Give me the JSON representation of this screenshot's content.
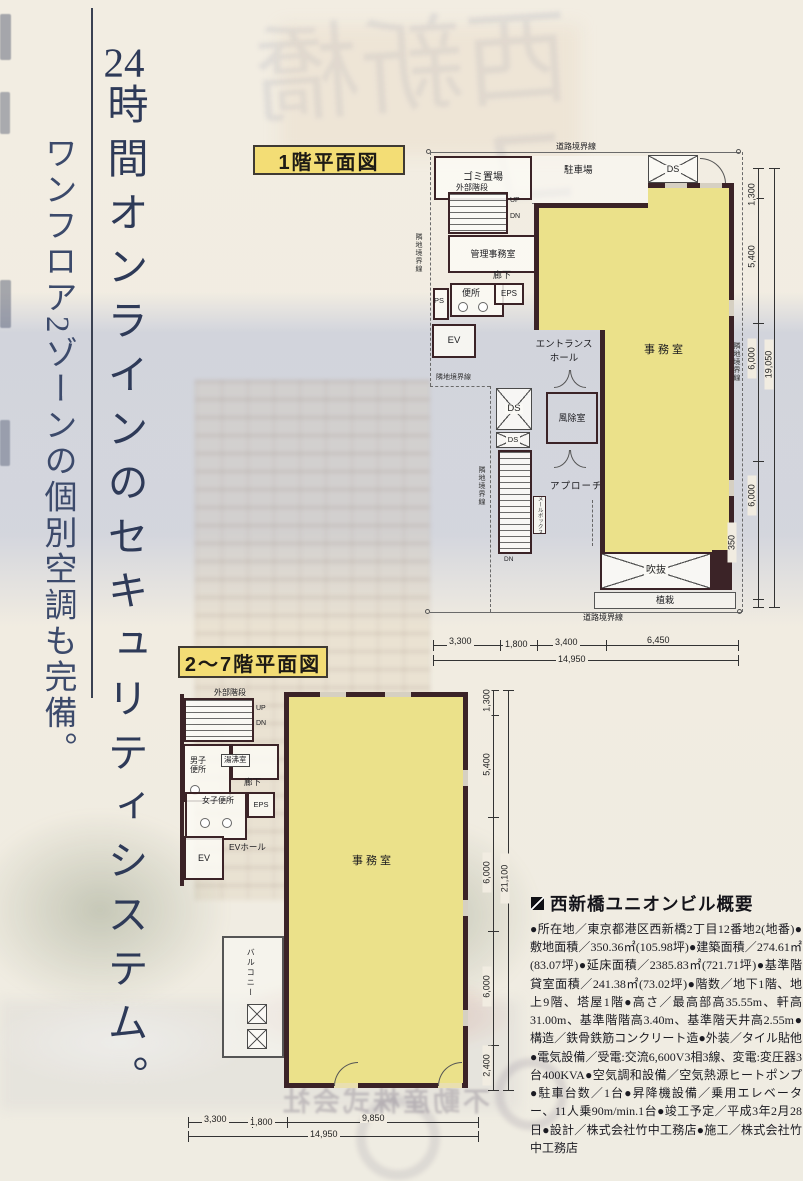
{
  "headline": {
    "num": "24",
    "line1_rest": "時間オンラインのセキュリティシステム。",
    "line2": "ワンフロア2ゾーンの個別空調も完備。"
  },
  "plan1": {
    "title": "1階平面図",
    "labels": {
      "road_boundary": "道路境界線",
      "adjacent_boundary": "隣地境界線",
      "garbage": "ゴミ置場",
      "parking": "駐車場",
      "ext_stairs": "外部階段",
      "up": "UP",
      "dn": "DN",
      "admin_office": "管理事務室",
      "corridor": "廊下",
      "toilet": "便所",
      "ps": "PS",
      "eps": "EPS",
      "ev": "EV",
      "entrance_l1": "エントランス",
      "entrance_l2": "ホール",
      "ds": "DS",
      "windbreak": "風除室",
      "approach": "アプローチ",
      "mailbox": "メールボックス",
      "void": "吹抜",
      "planting": "植栽",
      "office": "事務室"
    },
    "dims_right": [
      "1,300",
      "5,400",
      "6,000",
      "6,000",
      "350"
    ],
    "dims_right_total": "19,050",
    "dims_bottom": [
      "3,300",
      "1,800",
      "3,400",
      "6,450"
    ],
    "dims_bottom_total": "14,950"
  },
  "plan2": {
    "title": "2〜7階平面図",
    "labels": {
      "ext_stairs": "外部階段",
      "up": "UP",
      "dn": "DN",
      "men_toilet": "男子便所",
      "kitchenette": "湯沸室",
      "corridor": "廊下",
      "women_toilet": "女子便所",
      "eps": "EPS",
      "ev": "EV",
      "ev_hall": "EVホール",
      "balcony": "バルコニー",
      "office": "事務室"
    },
    "dims_right": [
      "1,300",
      "5,400",
      "6,000",
      "6,000",
      "2,400"
    ],
    "dims_right_total": "21,100",
    "dims_bottom": [
      "3,300",
      "1,800",
      "9,850"
    ],
    "dims_bottom_total": "14,950"
  },
  "overview": {
    "title": "西新橋ユニオンビル概要",
    "body": "●所在地／東京都港区西新橋2丁目12番地2(地番)●敷地面積／350.36㎡(105.98坪)●建築面積／274.61㎡(83.07坪)●延床面積／2385.83㎡(721.71坪)●基準階貸室面積／241.38㎡(73.02坪)●階数／地下1階、地上9階、塔屋1階●高さ／最高部高35.55m、軒高31.00m、基準階階高3.40m、基準階天井高2.55m●構造／鉄骨鉄筋コンクリート造●外装／タイル貼他●電気設備／受電:交流6,600V3相3線、変電:変圧器3台400KVA●空気調和設備／空気熱源ヒートポンプ●駐車台数／1台●昇降機設備／乗用エレベーター、11人乗90m/min.1台●竣工予定／平成3年2月28日●設計／株式会社竹中工務店●施工／株式会社竹中工務店"
  },
  "ghost": {
    "company": "不動産株式会社",
    "cover_title": "西新橋ユ"
  },
  "colors": {
    "office_fill": "#ebe18a",
    "title_box_fill": "#f3dd75",
    "wall": "#3b2327",
    "headline_text": "#2e3a58",
    "page_background": "#f1ece1"
  }
}
